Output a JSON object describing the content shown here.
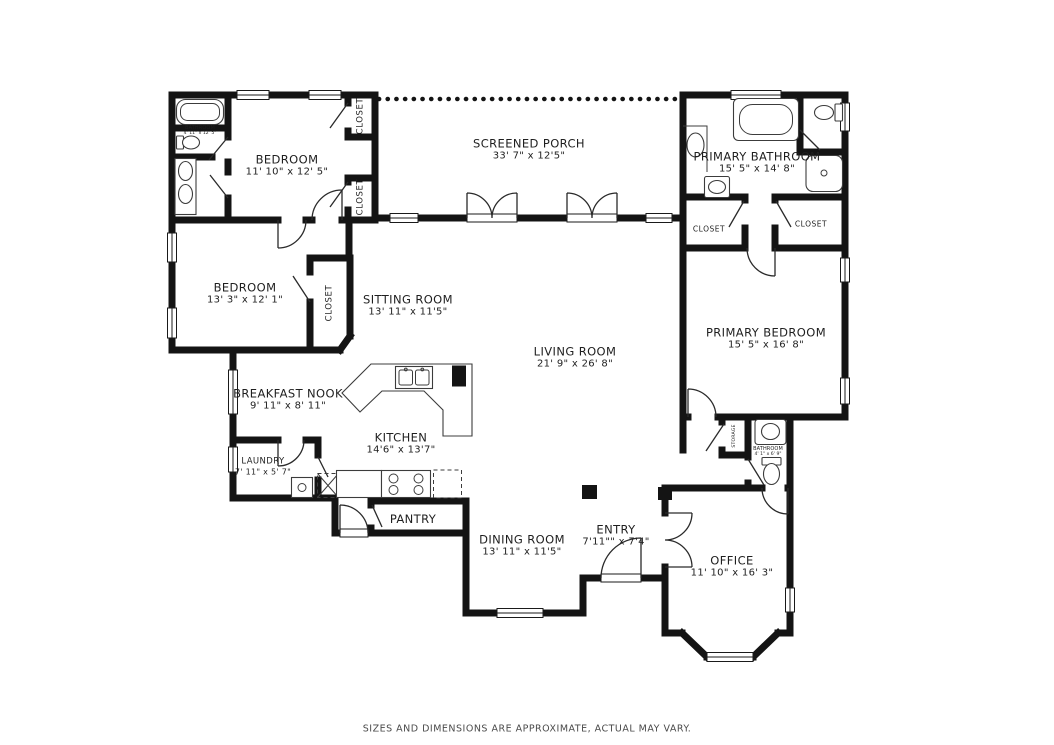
{
  "rooms": {
    "bathroom_tl": {
      "name": "BATHROOM",
      "dims": "4' 11\" x 12' 5\""
    },
    "bedroom1": {
      "name": "BEDROOM",
      "dims": "11' 10\" x 12' 5\""
    },
    "screened_porch": {
      "name": "SCREENED PORCH",
      "dims": "33' 7\" x 12'5\""
    },
    "primary_bathroom": {
      "name": "PRIMARY BATHROOM",
      "dims": "15' 5\" x 14' 8\""
    },
    "bedroom2": {
      "name": "BEDROOM",
      "dims": "13' 3\" x 12' 1\""
    },
    "sitting_room": {
      "name": "SITTING ROOM",
      "dims": "13' 11\" x 11'5\""
    },
    "living_room": {
      "name": "LIVING ROOM",
      "dims": "21' 9\" x 26' 8\""
    },
    "primary_bedroom": {
      "name": "PRIMARY BEDROOM",
      "dims": "15' 5\" x 16' 8\""
    },
    "breakfast_nook": {
      "name": "BREAKFAST NOOK",
      "dims": "9' 11\" x 8' 11\""
    },
    "kitchen": {
      "name": "KITCHEN",
      "dims": "14'6\" x 13'7\""
    },
    "laundry": {
      "name": "LAUNDRY",
      "dims": "7' 11\" x 5' 7\""
    },
    "pantry": {
      "name": "PANTRY"
    },
    "dining_room": {
      "name": "DINING ROOM",
      "dims": "13' 11\" x 11'5\""
    },
    "entry": {
      "name": "ENTRY",
      "dims": "7'11\"\" x 7'4\""
    },
    "office": {
      "name": "OFFICE",
      "dims": "11' 10\" x 16' 3\""
    },
    "bathroom_office": {
      "name": "BATHROOM",
      "dims": "4' 1\" x 6' 9\""
    }
  },
  "labels": {
    "closet": "CLOSET",
    "storage": "STORAGE"
  },
  "footer": {
    "disclaimer": "SIZES AND DIMENSIONS ARE APPROXIMATE, ACTUAL MAY VARY."
  },
  "colors": {
    "wall": "#141414",
    "text": "#1f1f1f",
    "background": "#ffffff",
    "footer_text": "#4a4a4a"
  }
}
